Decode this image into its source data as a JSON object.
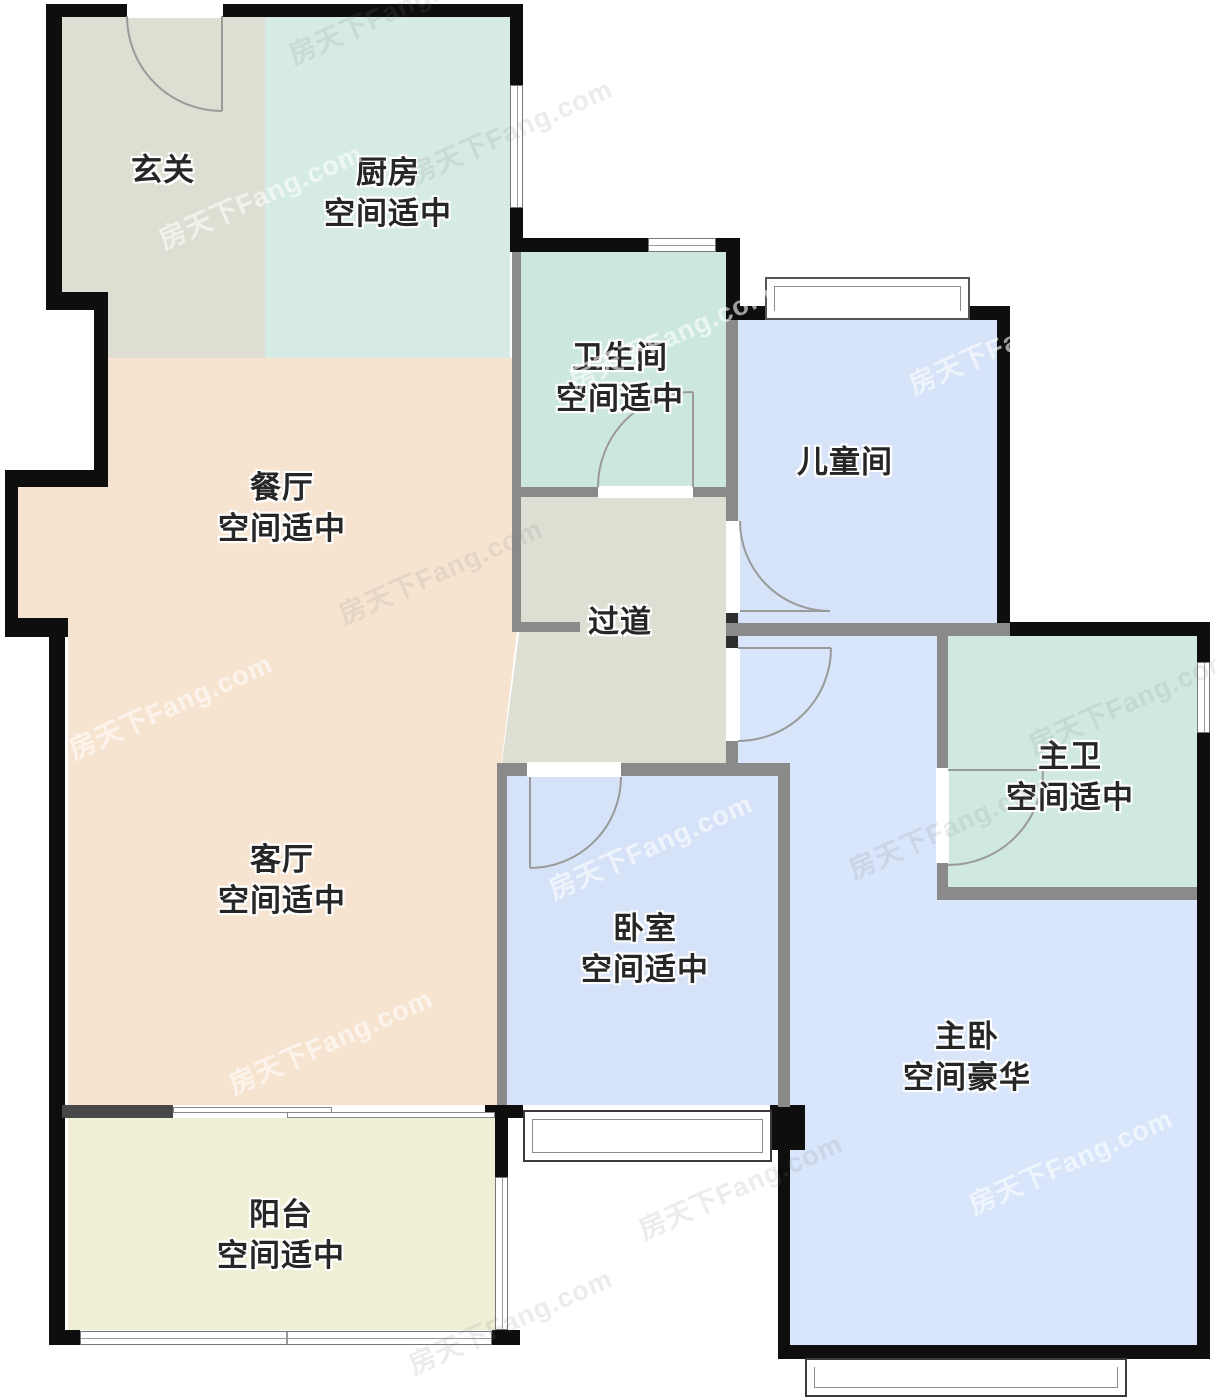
{
  "watermark": {
    "text": "房天下Fang.com"
  },
  "palette": {
    "entry": "#DEDED2",
    "kitchen": "#D5EBE3",
    "bathroom": "#CCE8DE",
    "kids_room": "#D7E3F8",
    "dining_living": "#F7E4D0",
    "hallway": "#DEDFD3",
    "master_bathroom": "#CFE9E1",
    "bedroom": "#D6E2F8",
    "master_bedroom": "#D8E5FA",
    "balcony": "#F0EFD5",
    "wall_exterior": "#0E0E0E",
    "wall_interior": "#8A8A8A",
    "door_arc": "#9A9A9A",
    "label_text": "#262626"
  },
  "rooms": [
    {
      "id": "entry",
      "name": "玄关",
      "quality": ""
    },
    {
      "id": "kitchen",
      "name": "厨房",
      "quality": "空间适中"
    },
    {
      "id": "bathroom",
      "name": "卫生间",
      "quality": "空间适中"
    },
    {
      "id": "kids-room",
      "name": "儿童间",
      "quality": ""
    },
    {
      "id": "dining-room",
      "name": "餐厅",
      "quality": "空间适中"
    },
    {
      "id": "hallway",
      "name": "过道",
      "quality": ""
    },
    {
      "id": "master-bathroom",
      "name": "主卫",
      "quality": "空间适中"
    },
    {
      "id": "living-room",
      "name": "客厅",
      "quality": "空间适中"
    },
    {
      "id": "bedroom",
      "name": "卧室",
      "quality": "空间适中"
    },
    {
      "id": "master-bedroom",
      "name": "主卧",
      "quality": "空间豪华"
    },
    {
      "id": "balcony",
      "name": "阳台",
      "quality": "空间适中"
    }
  ]
}
